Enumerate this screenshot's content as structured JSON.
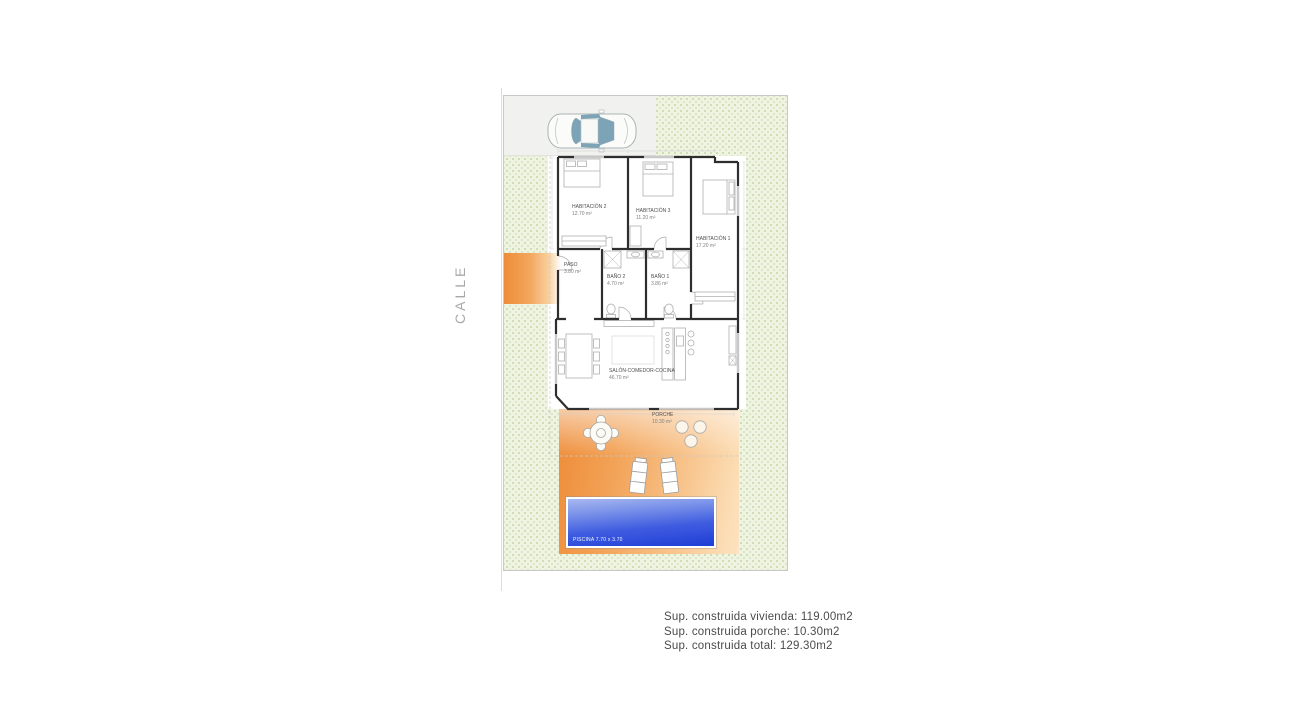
{
  "street_label": "CALLE",
  "rooms": {
    "habitacion2": {
      "name": "HABITACIÓN 2",
      "area": "12.70 m²"
    },
    "habitacion3": {
      "name": "HABITACIÓN 3",
      "area": "11.20 m²"
    },
    "habitacion1": {
      "name": "HABITACIÓN 1",
      "area": "17.20 m²"
    },
    "paso": {
      "name": "PASO",
      "area": "3.80 m²"
    },
    "bano2": {
      "name": "BAÑO 2",
      "area": "4.70 m²"
    },
    "bano1": {
      "name": "BAÑO 1",
      "area": "3.86 m²"
    },
    "salon": {
      "name": "SALÓN-COMEDOR-COCINA",
      "area": "46.70 m²"
    },
    "porche": {
      "name": "PORCHE",
      "area": "10.30 m²"
    }
  },
  "pool": {
    "label": "PISCINA 7.70 x 3.70"
  },
  "summary": {
    "lines": [
      "Sup. construida vivienda: 119.00m2",
      "Sup. construida porche: 10.30m2",
      "Sup. construida total: 129.30m2"
    ]
  },
  "colors": {
    "terrace_orange": "#ee8c38",
    "pool_blue": "#1e3ed6",
    "garden_green": "#eef3e2",
    "driveway_gray": "#f1f1ef",
    "wall_black": "#2e2e2e"
  }
}
